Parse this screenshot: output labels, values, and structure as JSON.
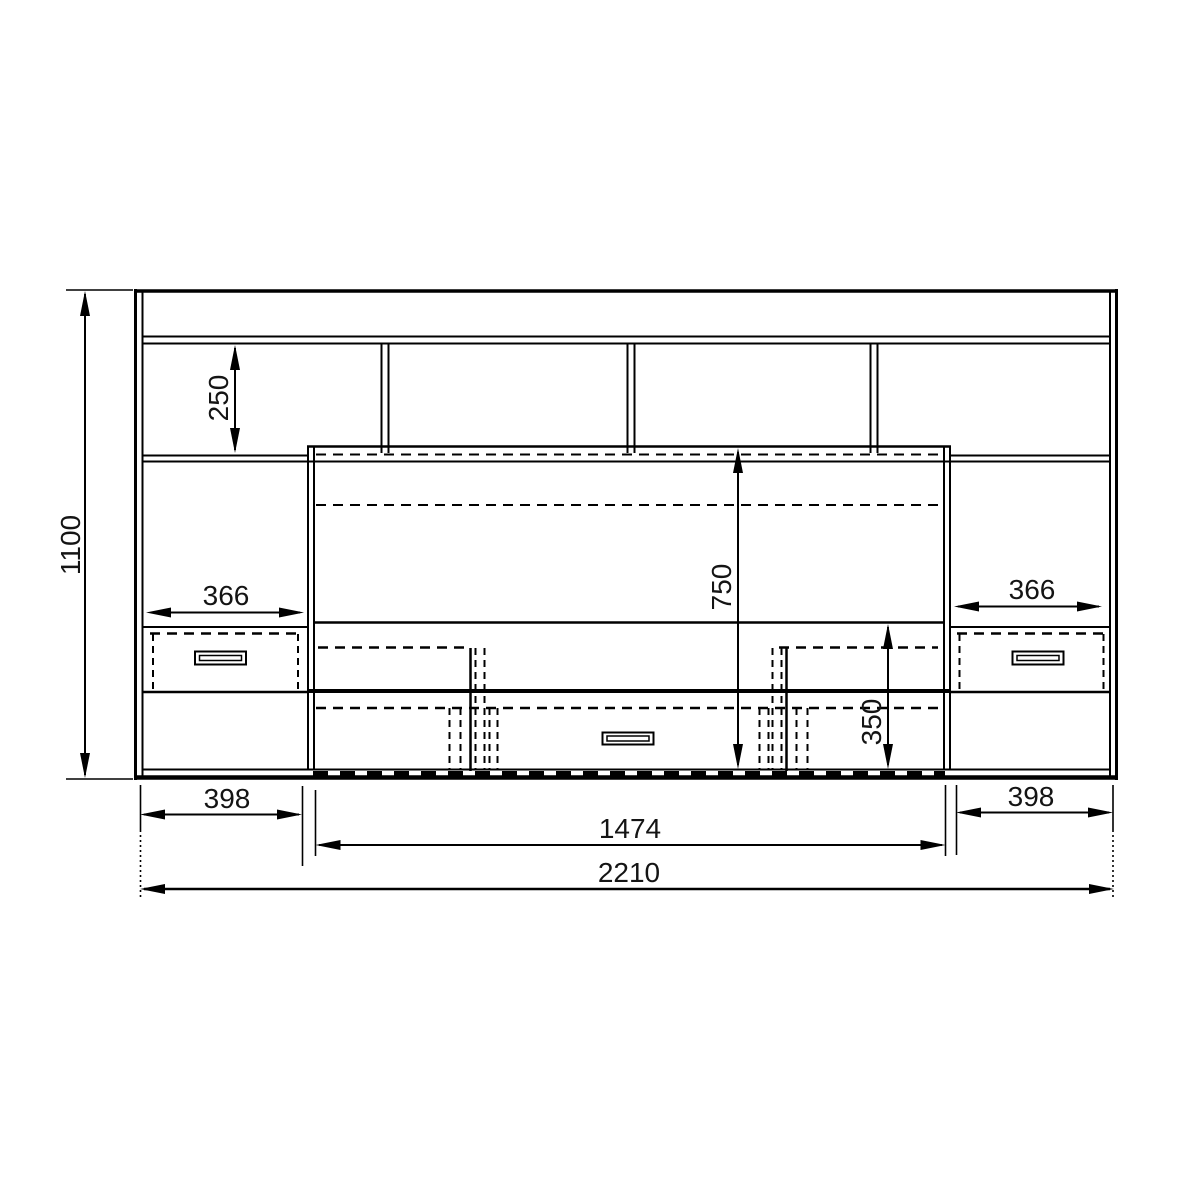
{
  "drawing": {
    "type": "furniture-front-elevation",
    "background": "#ffffff",
    "line_color": "#000000"
  },
  "dims": {
    "overall_width": "2210",
    "overall_height": "1100",
    "center_section_width": "1474",
    "left_section_width": "398",
    "right_section_width": "398",
    "top_shelf_height": "250",
    "tv_section_height": "750",
    "base_zone_height": "350",
    "left_drawer_width": "366",
    "right_drawer_width": "366"
  }
}
